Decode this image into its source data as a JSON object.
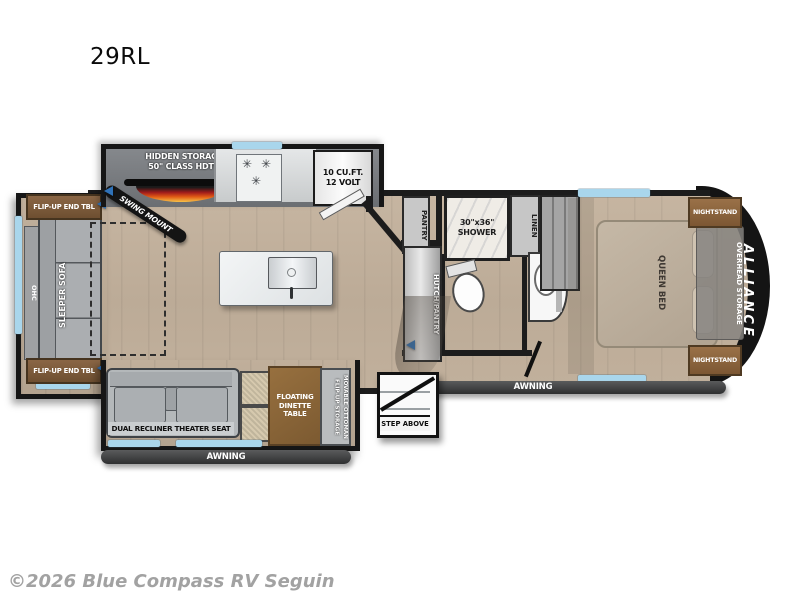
{
  "model": "29RL",
  "brand": "ALLIANCE",
  "copyright": "©2026 Blue Compass RV Seguin",
  "colors": {
    "window_blue": "#a9d6ec",
    "floor_tan": "#c2b19d",
    "wall_black": "#1c1c1c",
    "awning_gray": "#3a3b3c",
    "marker_blue": "#2f72b8",
    "fireplace_flame": "#e25b15"
  },
  "rear_slide": {
    "end_table_top": "FLIP-UP END TBL",
    "end_table_bottom": "FLIP-UP END TBL",
    "ohc": "OHC",
    "sofa": "SLEEPER SOFA"
  },
  "kitchen": {
    "hidden_storage_line1": "HIDDEN STORAGE",
    "hidden_storage_line2": "50\" CLASS HDTV",
    "swing_mount": "SWING MOUNT",
    "burner_glyph": "✳",
    "fridge_line1": "10 CU.FT.",
    "fridge_line2": "12 VOLT",
    "pantry": "PANTRY"
  },
  "bath": {
    "shower_line1": "30\"x36\"",
    "shower_line2": "SHOWER",
    "linen": "LINEN",
    "hutch": "HUTCH/PANTRY"
  },
  "bedroom": {
    "queen_bed": "QUEEN BED",
    "overhead_storage": "OVERHEAD STORAGE",
    "nightstand_top": "NIGHTSTAND",
    "nightstand_bottom": "NIGHTSTAND"
  },
  "door_slide": {
    "theater_seat": "DUAL RECLINER THEATER SEAT",
    "dinette_table": "FLOATING DINETTE TABLE",
    "ottoman": "MOVABLE OTTOMAN FLIP-UP STORAGE"
  },
  "exterior": {
    "awning_left": "AWNING",
    "awning_right": "AWNING",
    "step": "STEP ABOVE"
  }
}
